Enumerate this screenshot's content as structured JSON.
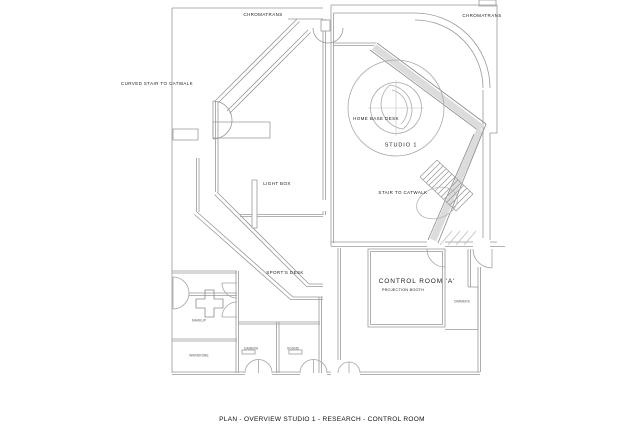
{
  "title": "PLAN - OVERVIEW STUDIO 1 - RESEARCH - CONTROL ROOM",
  "labels": {
    "chromatrans_left": "CHROMATRANS",
    "chromatrans_right": "CHROMATRANS",
    "curved_stair": "CURVED STAIR TO CATWALK",
    "home_base_desk": "HOME BASE DESK",
    "studio_1": "STUDIO 1",
    "light_box": "LIGHT BOX",
    "stair_to_catwalk": "STAIR TO CATWALK",
    "sports_desk": "SPORT'S DESK",
    "control_room_a": "CONTROL ROOM 'A'",
    "projection_booth": "PROJECTION BOOTH",
    "dimmers": "DIMMERS",
    "makeup_room": "MAKEUP",
    "wardrobe_room": "WARDROBE",
    "camera_room": "CAMERA",
    "sound_room": "SOUND"
  },
  "colors": {
    "background": "#ffffff",
    "wall_line": "#999999",
    "wall_line_dark": "#7d7d7d",
    "wall_fill": "#dcdcdc",
    "text": "#1c1c1c"
  }
}
